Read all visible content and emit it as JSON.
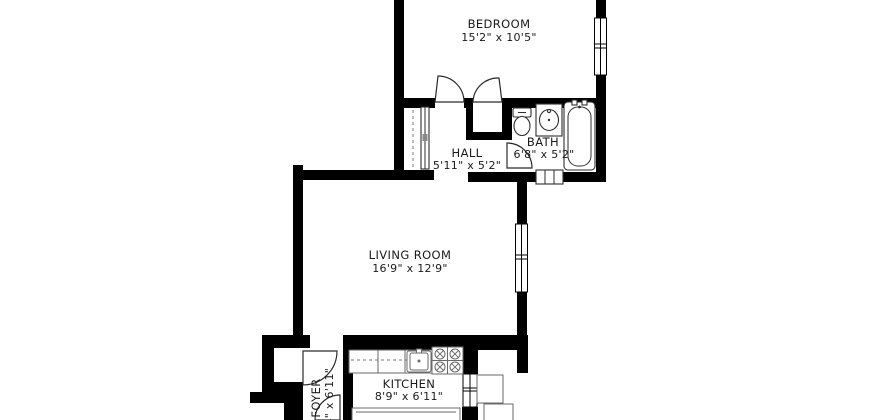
{
  "colors": {
    "wall": "#000000",
    "background": "#ffffff",
    "text": "#1a1a1a",
    "kitchen_fixture_stroke": "#6a6a6a",
    "bath_fixture_stroke": "#2e2e2e"
  },
  "rooms": {
    "bedroom": {
      "label": "BEDROOM",
      "dims": "15'2\" x 10'5\""
    },
    "hall": {
      "label": "HALL",
      "dims": "5'11\" x 5'2\""
    },
    "bath": {
      "label": "BATH",
      "dims": "6'8\" x 5'2\""
    },
    "living_room": {
      "label": "LIVING ROOM",
      "dims": "16'9\" x 12'9\""
    },
    "foyer": {
      "label": "FOYER",
      "dims": "3'4\" x 6'11\""
    },
    "kitchen": {
      "label": "KITCHEN",
      "dims": "8'9\" x 6'11\""
    }
  },
  "fixtures": [
    "toilet",
    "bath-sink",
    "bathtub",
    "radiator",
    "hall-closet",
    "bedroom-closet",
    "kitchen-counter",
    "kitchen-sink",
    "stove",
    "kitchen-island",
    "bedroom-window",
    "living-room-window",
    "kitchen-window",
    "bedroom-door-swing",
    "bedroom-closet-door-swing",
    "bath-door-swing",
    "entry-door-swing",
    "kitchen-door-swing"
  ]
}
